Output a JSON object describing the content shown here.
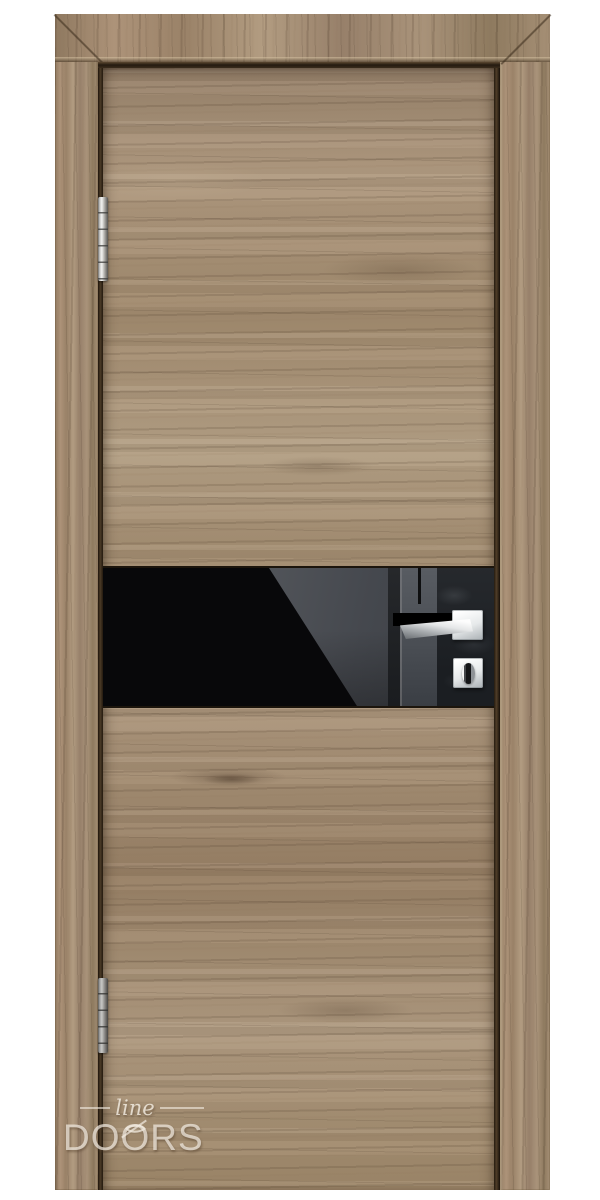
{
  "photo": {
    "subject": "Interior door product photo: light oak woodgrain leaf and frame, full-width horizontal black gloss glass insert, chrome square-rosette lever handle with thumb-turn lock, two chrome barrel hinges on the left",
    "background_color": "#ffffff"
  },
  "watermark": {
    "script_text": "line",
    "letters": [
      "D",
      "O",
      "O",
      "RS"
    ],
    "full_text": "line DOORS",
    "color": "rgba(243,236,226,0.72)"
  },
  "colors": {
    "wood_base": "#a7917a",
    "wood_shadow": "#6e5942",
    "wood_highlight": "#c3af93",
    "gap_dark": "#2c2113",
    "glass_black": "#08080a",
    "reflection_gray": "#53565c",
    "chrome_bright": "#f4f5f5",
    "hinge_silver": "#c9c9c7"
  }
}
